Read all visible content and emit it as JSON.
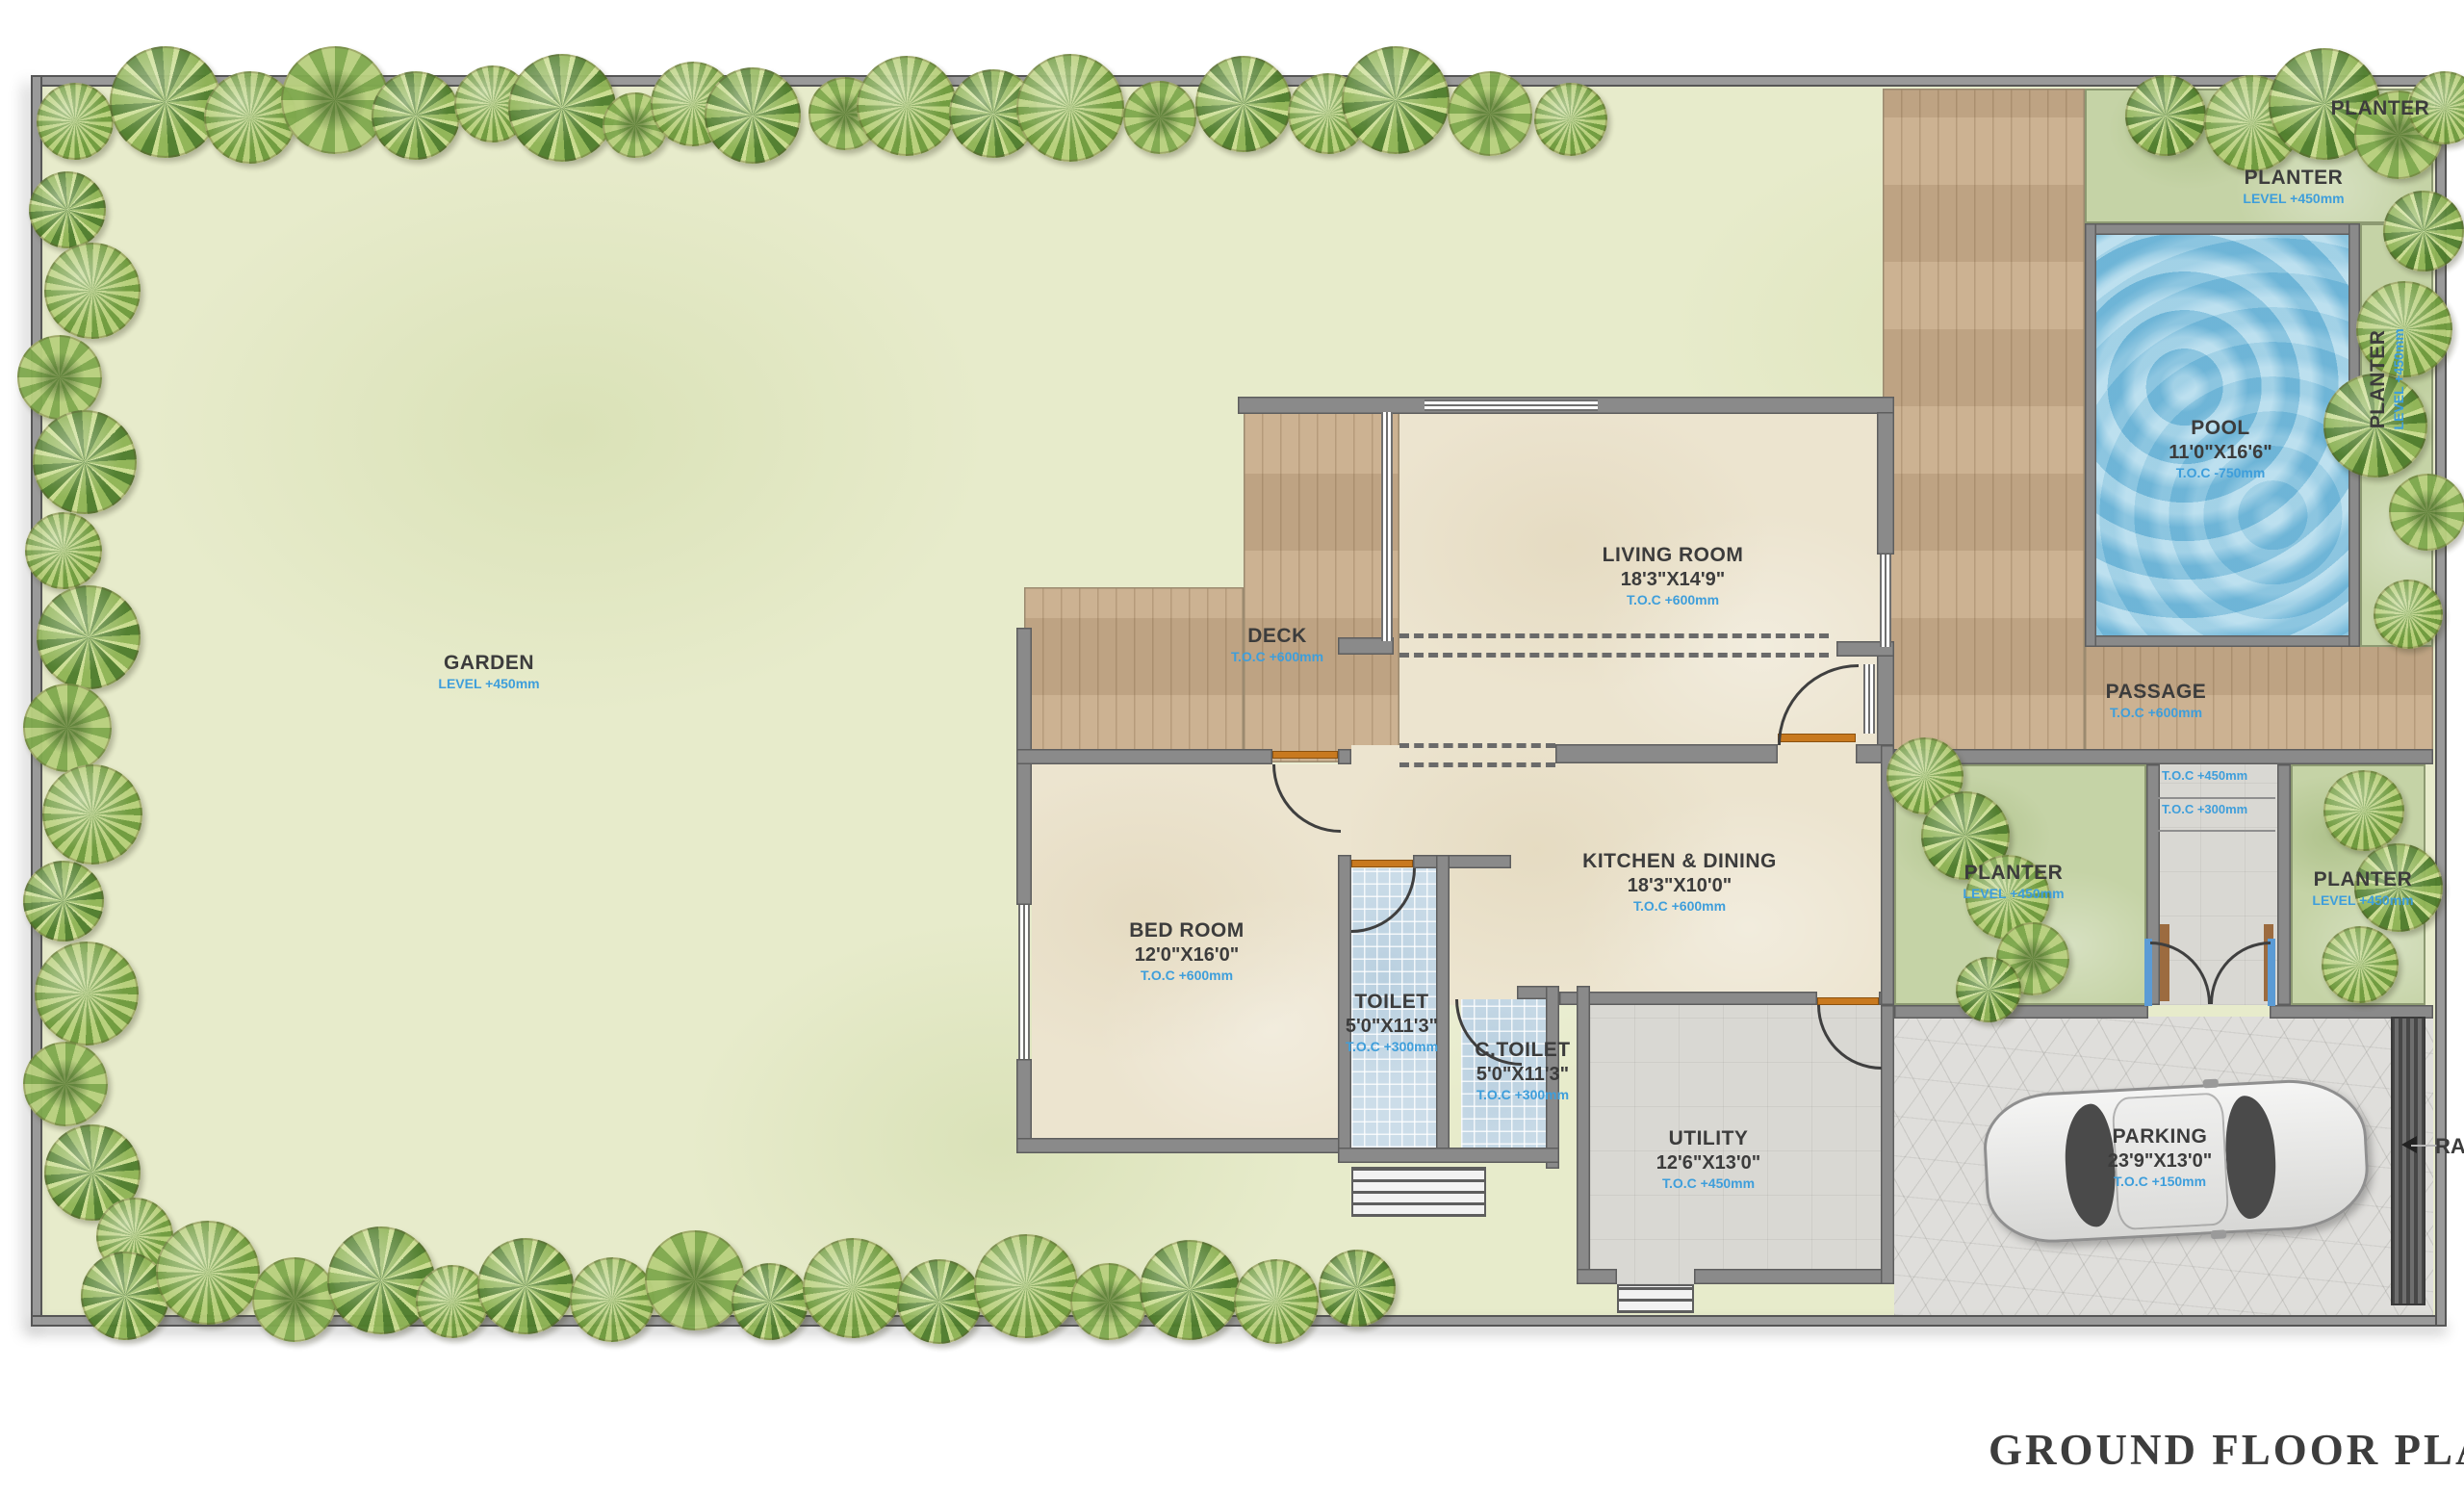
{
  "title": "GROUND FLOOR PLAN",
  "colors": {
    "label_blue": "#3E9EDB",
    "label_dark": "#3C3C3C",
    "pool_water": "#85C6E2",
    "wood": "#C8AC8A",
    "garden": "#E7EBCB"
  },
  "rooms": {
    "garden": {
      "name": "GARDEN",
      "note": "LEVEL +450mm"
    },
    "deck": {
      "name": "DECK",
      "note": "T.O.C +600mm"
    },
    "living": {
      "name": "LIVING ROOM",
      "dim": "18'3\"X14'9\"",
      "note": "T.O.C +600mm"
    },
    "pool": {
      "name": "POOL",
      "dim": "11'0\"X16'6\"",
      "note": "T.O.C -750mm"
    },
    "passage": {
      "name": "PASSAGE",
      "note": "T.O.C +600mm"
    },
    "bedroom": {
      "name": "BED ROOM",
      "dim": "12'0\"X16'0\"",
      "note": "T.O.C +600mm"
    },
    "toilet": {
      "name": "TOILET",
      "dim": "5'0\"X11'3\"",
      "note": "T.O.C +300mm"
    },
    "ctoilet": {
      "name": "C.TOILET",
      "dim": "5'0\"X11'3\"",
      "note": "T.O.C +300mm"
    },
    "kitchen": {
      "name": "KITCHEN & DINING",
      "dim": "18'3\"X10'0\"",
      "note": "T.O.C +600mm"
    },
    "utility": {
      "name": "UTILITY",
      "dim": "12'6\"X13'0\"",
      "note": "T.O.C +450mm"
    },
    "parking": {
      "name": "PARKING",
      "dim": "23'9\"X13'0\"",
      "note": "T.O.C +150mm"
    },
    "planter_mid": {
      "name": "PLANTER",
      "note": "LEVEL +450mm"
    },
    "planter_right": {
      "name": "PLANTER",
      "note": "LEVEL +450mm"
    },
    "planter_top": {
      "name": "PLANTER",
      "note": "LEVEL +450mm"
    },
    "planter_top_corner": {
      "name": "PLANTER"
    },
    "planter_pool_side": {
      "name": "PLANTER",
      "note": "LEVEL +450mm"
    }
  },
  "entry_steps": {
    "upper": "T.O.C +450mm",
    "lower": "T.O.C +300mm"
  },
  "ramp": {
    "label": "RAMP"
  },
  "scenery": {
    "trees": [
      [
        78,
        126,
        40,
        1
      ],
      [
        172,
        106,
        58,
        2
      ],
      [
        260,
        122,
        48,
        1
      ],
      [
        348,
        104,
        56,
        3
      ],
      [
        432,
        120,
        46,
        2
      ],
      [
        512,
        108,
        40,
        1
      ],
      [
        584,
        112,
        56,
        2
      ],
      [
        660,
        130,
        34,
        3
      ],
      [
        720,
        108,
        44,
        1
      ],
      [
        782,
        120,
        50,
        2
      ],
      [
        878,
        118,
        38,
        3
      ],
      [
        942,
        110,
        52,
        1
      ],
      [
        1032,
        118,
        46,
        2
      ],
      [
        1112,
        112,
        56,
        1
      ],
      [
        1205,
        122,
        38,
        3
      ],
      [
        1292,
        108,
        50,
        2
      ],
      [
        1380,
        118,
        42,
        1
      ],
      [
        1450,
        104,
        56,
        2
      ],
      [
        1548,
        118,
        44,
        3
      ],
      [
        1632,
        124,
        38,
        1
      ],
      [
        2250,
        120,
        42,
        2
      ],
      [
        2340,
        128,
        50,
        1
      ],
      [
        2415,
        108,
        58,
        2
      ],
      [
        2492,
        140,
        46,
        3
      ],
      [
        2540,
        112,
        38,
        1
      ],
      [
        2518,
        240,
        42,
        2
      ],
      [
        2498,
        342,
        50,
        1
      ],
      [
        2468,
        442,
        54,
        2
      ],
      [
        2522,
        532,
        40,
        3
      ],
      [
        2502,
        638,
        36,
        1
      ],
      [
        70,
        218,
        40,
        2
      ],
      [
        96,
        302,
        50,
        1
      ],
      [
        62,
        392,
        44,
        3
      ],
      [
        88,
        480,
        54,
        2
      ],
      [
        66,
        572,
        40,
        1
      ],
      [
        92,
        662,
        54,
        2
      ],
      [
        70,
        756,
        46,
        3
      ],
      [
        96,
        846,
        52,
        1
      ],
      [
        66,
        936,
        42,
        2
      ],
      [
        90,
        1032,
        54,
        1
      ],
      [
        68,
        1126,
        44,
        3
      ],
      [
        96,
        1218,
        50,
        2
      ],
      [
        140,
        1284,
        40,
        1
      ],
      [
        130,
        1346,
        46,
        2
      ],
      [
        216,
        1322,
        54,
        1
      ],
      [
        306,
        1350,
        44,
        3
      ],
      [
        396,
        1330,
        56,
        2
      ],
      [
        470,
        1352,
        38,
        1
      ],
      [
        546,
        1336,
        50,
        2
      ],
      [
        636,
        1350,
        44,
        1
      ],
      [
        722,
        1330,
        52,
        3
      ],
      [
        800,
        1352,
        40,
        2
      ],
      [
        886,
        1338,
        52,
        1
      ],
      [
        976,
        1352,
        44,
        2
      ],
      [
        1066,
        1336,
        54,
        1
      ],
      [
        1152,
        1352,
        40,
        3
      ],
      [
        1236,
        1340,
        52,
        2
      ],
      [
        1326,
        1352,
        44,
        1
      ],
      [
        1410,
        1338,
        40,
        2
      ],
      [
        2000,
        806,
        40,
        1
      ],
      [
        2042,
        868,
        46,
        2
      ],
      [
        2086,
        932,
        44,
        1
      ],
      [
        2112,
        996,
        38,
        3
      ],
      [
        2066,
        1028,
        34,
        2
      ],
      [
        2456,
        842,
        42,
        1
      ],
      [
        2492,
        922,
        46,
        2
      ],
      [
        2452,
        1002,
        40,
        1
      ]
    ]
  }
}
